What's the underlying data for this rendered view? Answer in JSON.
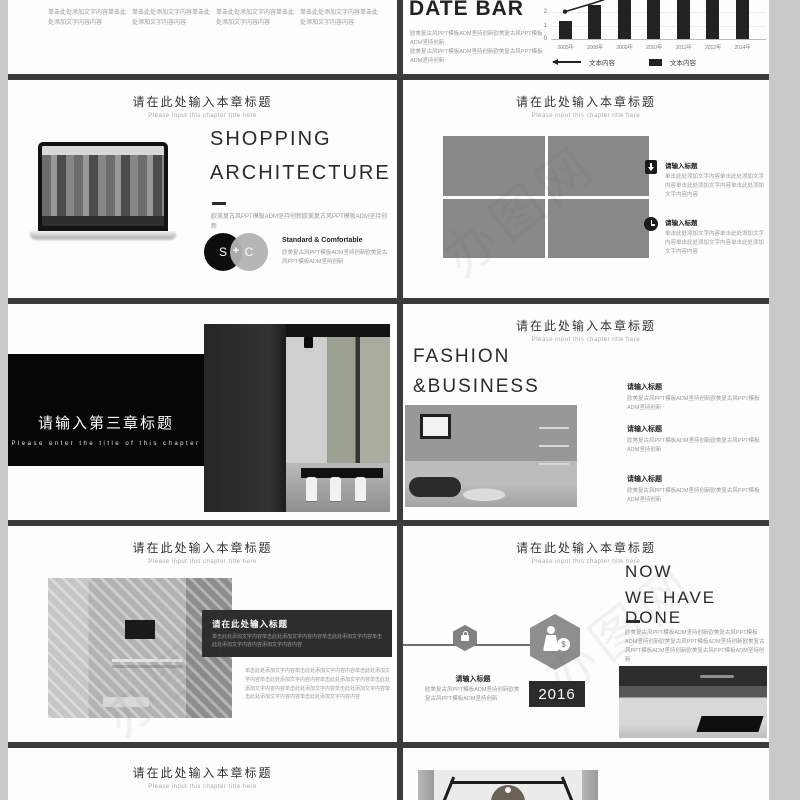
{
  "page": {
    "bg_color": "#c9c9c9",
    "divider_color": "#3b3b3b",
    "watermark_text": "办图网"
  },
  "chart_data": {
    "type": "bar",
    "title": "DATE BAR",
    "categories": [
      "2005年",
      "2008年",
      "2009年",
      "2010年",
      "2011年",
      "2012年",
      "2014年"
    ],
    "values": [
      1.3,
      2.5,
      3.6,
      3.8,
      4.0,
      4.2,
      4.5
    ],
    "line_values": [
      2.1,
      2.75,
      3.5
    ],
    "yticks": [
      0,
      1,
      2
    ],
    "ylim_visible": [
      0,
      3
    ],
    "grid": true,
    "legend_position": "bottom",
    "legend": [
      {
        "marker": "line-arrow",
        "label": "文本内容"
      },
      {
        "marker": "bar",
        "label": "文本内容"
      }
    ]
  },
  "slides": {
    "s1_left": {
      "blocks": [
        "单击此处添加文字内容单击此处添加文字内容内容",
        "单击此处添加文字内容单击此处添加文字内容内容",
        "单击此处添加文字内容单击此处添加文字内容内容",
        "单击此处添加文字内容单击此处添加文字内容内容"
      ]
    },
    "s1_right": {
      "title": "DATE BAR",
      "desc1": "欧美复古风PPT模板ADM坚持创新欧美复古风PPT模板ADM坚持创新",
      "desc2": "欧美复古风PPT模板ADM坚持创新欧美复古风PPT模板ADM坚持创新"
    },
    "s2_left": {
      "chapter_title": "请在此处输入本章标题",
      "chapter_subtitle": "Please input this chapter title here",
      "heading1": "SHOPPING",
      "heading2": "ARCHITECTURE",
      "desc": "欧美复古风PPT模板ADM坚持创新欧美复古风PPT模板ADM坚持创新",
      "venn_left": "S",
      "venn_plus": "+",
      "venn_right": "C",
      "feature_title": "Standard & Comfortable",
      "feature_desc": "欧美复古风PPT模板ADM坚持创新欧美复古风PPT模板ADM坚持创新"
    },
    "s2_right": {
      "chapter_title": "请在此处输入本章标题",
      "chapter_subtitle": "Please input this chapter title here",
      "items": [
        {
          "icon": "download-document-icon",
          "title": "请输入标题",
          "desc": "单击此处添加文字内容单击此处添加文字内容单击此处添加文字内容单击此处添加文字内容内容"
        },
        {
          "icon": "alarm-clock-icon",
          "title": "请输入标题",
          "desc": "单击此处添加文字内容单击此处添加文字内容单击此处添加文字内容单击此处添加文字内容内容"
        }
      ]
    },
    "s3_left": {
      "banner_title": "请输入第三章标题",
      "banner_subtitle": "Please enter the title of this chapter"
    },
    "s3_right": {
      "chapter_title": "请在此处输入本章标题",
      "chapter_subtitle": "Please input this chapter title here",
      "heading1": "FASHION",
      "heading2": "&BUSINESS",
      "items": [
        {
          "title": "请输入标题",
          "desc": "欧美复古风PPT模板ADM坚持创新欧美复古风PPT模板ADM坚持创新"
        },
        {
          "title": "请输入标题",
          "desc": "欧美复古风PPT模板ADM坚持创新欧美复古风PPT模板ADM坚持创新"
        },
        {
          "title": "请输入标题",
          "desc": "欧美复古风PPT模板ADM坚持创新欧美复古风PPT模板ADM坚持创新"
        }
      ]
    },
    "s4_left": {
      "chapter_title": "请在此处输入本章标题",
      "chapter_subtitle": "Please input this chapter title here",
      "box_title": "请在此处输入标题",
      "box_desc": "单击此处添加文字内容单击此处添加文字内容内容单击此处添加文字内容单击此处添加文字内容内容添加文字内容内容",
      "paragraph": "单击此处添加文字内容单击此处添加文字内容内容单击此处添加文字内容单击此处添加文字内容内容单击此处添加文字内容单击此处添加文字内容内容单击此处添加文字内容单击此处添加文字内容单击此处添加文字内容内容单击此处添加文字内容内容"
    },
    "s4_right": {
      "chapter_title": "请在此处输入本章标题",
      "chapter_subtitle": "Please input this chapter title here",
      "heading1": "NOW",
      "heading2": "WE HAVE DONE",
      "desc": "欧美复古风PPT模板ADM坚持创新欧美复古风PPT模板ADM坚持创新欧美复古风PPT模板ADM坚持创新欧美复古风PPT模板ADM坚持创新欧美复古风PPT模板ADM坚持创新",
      "milestone_title": "请输入标题",
      "milestone_desc": "欧美复古风PPT模板ADM坚持创新欧美复古风PPT模板ADM坚持创新",
      "milestone_year": "2016",
      "money_symbol": "$"
    },
    "s5_left": {
      "chapter_title": "请在此处输入本章标题",
      "chapter_subtitle": "Please input this chapter title here"
    }
  }
}
